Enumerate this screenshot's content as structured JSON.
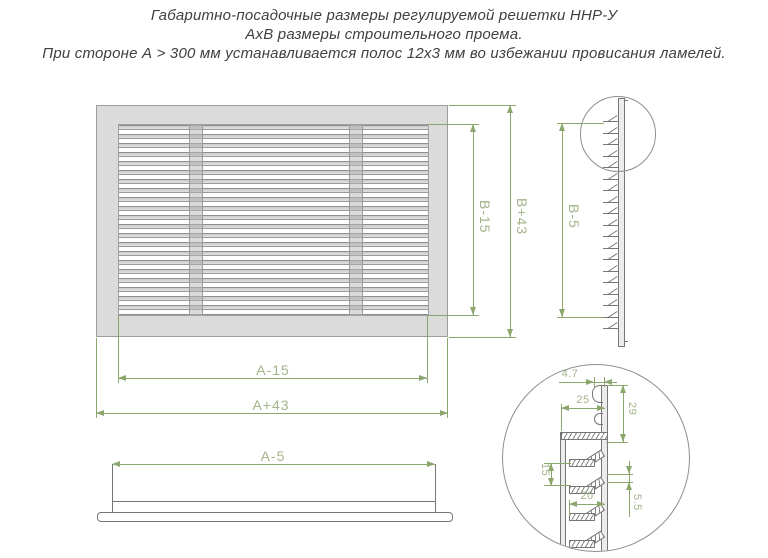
{
  "title": {
    "line1": "Габаритно-посадочные размеры регулируемой решетки ННР-У",
    "line2": "АхВ размеры строительного проема.",
    "line3": "При стороне А > 300 мм устанавливается полос 12х3 мм во избежании провисания ламелей."
  },
  "front_view": {
    "inner_height_label": "B-15",
    "outer_height_label": "B+43",
    "inner_width_label": "A-15",
    "outer_width_label": "A+43"
  },
  "side_view": {
    "height_label": "B-5"
  },
  "bottom_view": {
    "width_label": "A-5"
  },
  "detail_view": {
    "hook_gap": "4.7",
    "top_lamella_depth": "25",
    "top_offset": "29",
    "lamella_pitch": "15",
    "lamella_depth": "20",
    "lamella_gap": "5.5"
  },
  "colors": {
    "dimension_line": "#8ca76e",
    "dimension_text": "#a2b489",
    "drawing_line": "#767676",
    "frame_fill": "#dbdbdb"
  }
}
